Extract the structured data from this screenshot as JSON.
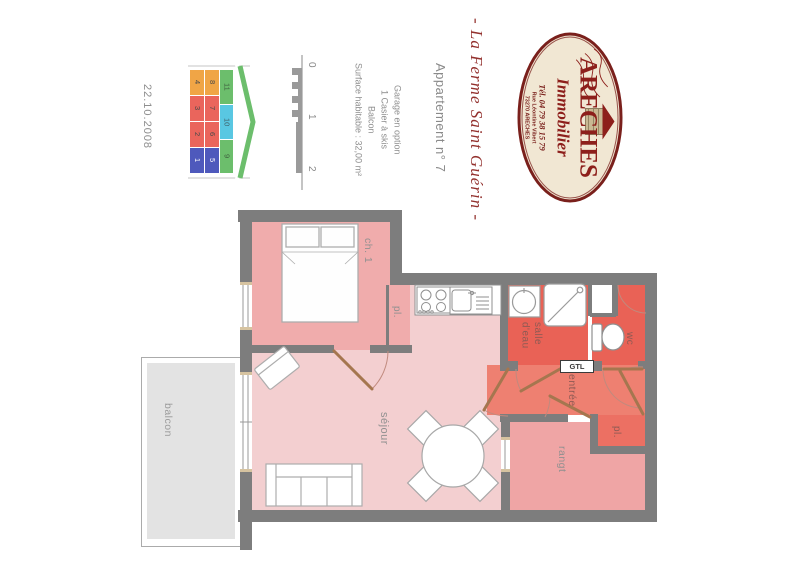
{
  "page": {
    "date": "22.10.2008"
  },
  "header": {
    "property_name": "- La Ferme Saint Guérin -",
    "apartment_label": "Appartement n° 7",
    "details": [
      "Surface habitable : 32,00 m²",
      "Balcon",
      "1 Casier à skis",
      "Garage en option"
    ]
  },
  "logo": {
    "agency_name": "ARECHES",
    "agency_subtitle": "Immobilier",
    "phone": "Tél. 04 79 38 15 79",
    "address_line1": "Rue Léontine Vibert",
    "address_line2": "73270 ARECHES"
  },
  "scale_bar": {
    "tick0": "0",
    "tick1": "1",
    "tick2": "2"
  },
  "location_key": {
    "column1": [
      {
        "label": "4",
        "color": "#F0A546",
        "text_color": "#4A4A4A"
      },
      {
        "label": "3",
        "color": "#EA655C",
        "text_color": "#4A4A4A"
      },
      {
        "label": "2",
        "color": "#EA655C",
        "text_color": "#4A4A4A"
      },
      {
        "label": "1",
        "color": "#4E59BC",
        "text_color": "#FFFFFF"
      }
    ],
    "column2": [
      {
        "label": "8",
        "color": "#F0A546",
        "text_color": "#4A4A4A"
      },
      {
        "label": "7",
        "color": "#EA655C",
        "text_color": "#4A4A4A"
      },
      {
        "label": "6",
        "color": "#EA655C",
        "text_color": "#4A4A4A"
      },
      {
        "label": "5",
        "color": "#4E59BC",
        "text_color": "#FFFFFF"
      }
    ],
    "column3": [
      {
        "label": "11",
        "color": "#6CBE6C",
        "text_color": "#3E5E3E"
      },
      {
        "label": "10",
        "color": "#59C7E2",
        "text_color": "#3E5E66"
      },
      {
        "label": "9",
        "color": "#6CBE6C",
        "text_color": "#3E5E3E"
      }
    ]
  },
  "rooms": {
    "bedroom": "ch. 1",
    "bedroom_closet": "pl.",
    "bathroom": "salle d'eau",
    "wc": "wc",
    "entry": "entrée",
    "living": "séjour",
    "storage": "rangt",
    "entry_closet": "pl.",
    "balcony": "balcon",
    "gtl": "GTL"
  },
  "colors": {
    "wall": "#7D7D7D",
    "living": "#F3CFD0",
    "bedroom": "#F0ACAC",
    "storage": "#EFA5A5",
    "bathroom": "#E96256",
    "wc": "#E96256",
    "entry": "#EE8071",
    "entry_closet": "#EC7063",
    "balcony": "#E3E3E3",
    "door_leaf": "#A5764F",
    "logo_red": "#8D1F1B",
    "script_red": "#93312E"
  }
}
